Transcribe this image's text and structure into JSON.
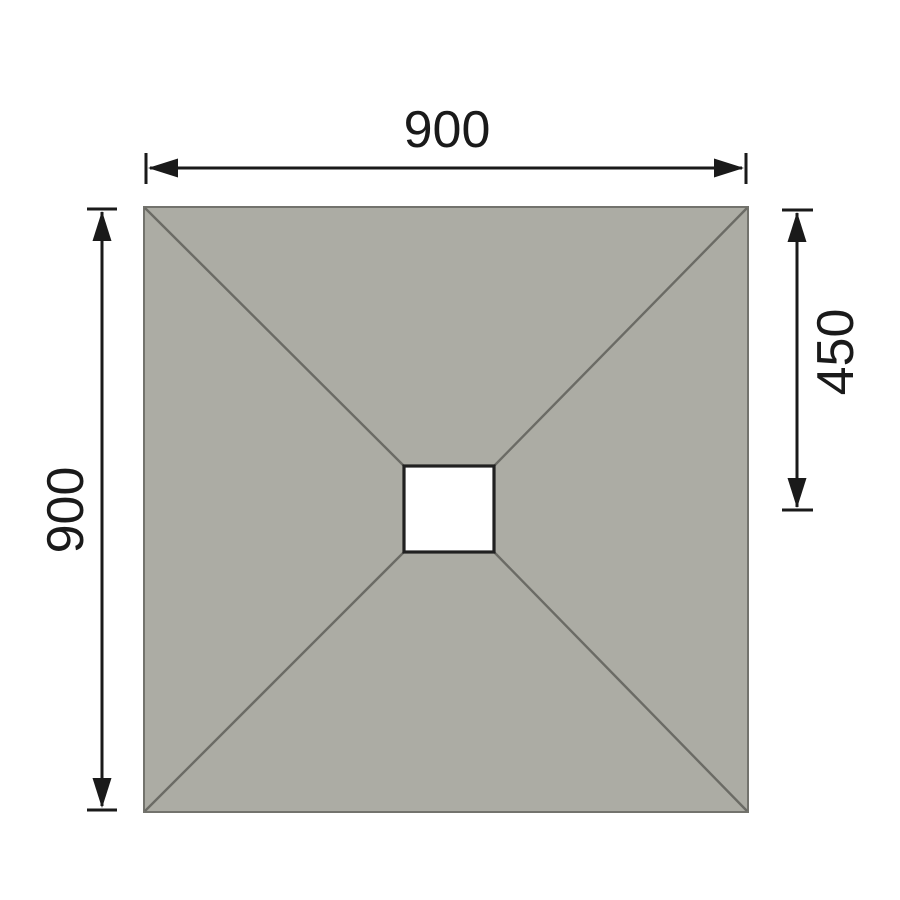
{
  "dimensions": {
    "top_width": "900",
    "left_height": "900",
    "right_drain_offset": "450"
  },
  "colors": {
    "background": "#FFFFFF",
    "tray_fill": "#ACACA4",
    "tray_outline": "#73736D",
    "slope_line": "#6B6B65",
    "dimension": "#1A1A1A",
    "drain_fill": "#FFFFFF",
    "drain_outline": "#212121"
  }
}
